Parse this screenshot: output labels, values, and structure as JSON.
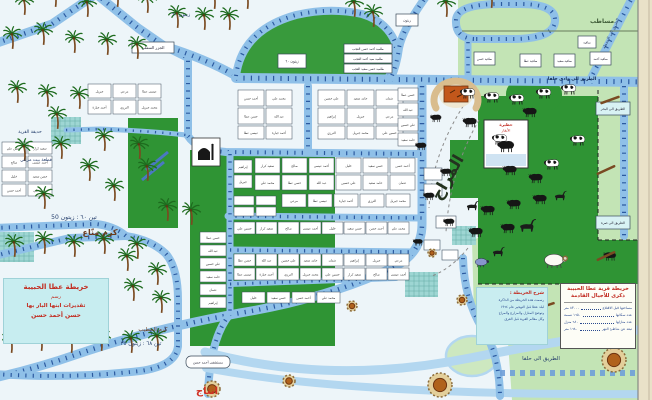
{
  "colors": {
    "bg": "#edf5f9",
    "road": "#8fc0e8",
    "road_light": "#b3d7f0",
    "tick": "#2c5aa0",
    "light_green": "#c3e4b5",
    "dark_green": "#2f9434",
    "dome": "#389a3c",
    "teal": "#9ed6d3",
    "edge": "#e9e1c8",
    "pond": "#cde8c0"
  },
  "legend": {
    "title1": "خريطة قرية عطا الحبيبة",
    "title2": "ذكرى للأجيال القادمة",
    "stats": [
      {
        "label": "مساحتها قبل الاقتلاع",
        "value": "٨٣٠٠٠ متر"
      },
      {
        "label": "عدد سكانها",
        "value": "١٦٥٠ نسمة"
      },
      {
        "label": "عدد منازلها",
        "value": "٦٨٠ منزل"
      },
      {
        "label": "تبعد عن شاطئ النهر",
        "value": "١٦٨٠ متر"
      }
    ]
  },
  "note_box": {
    "heading": "شرح الخريطة :",
    "lines": [
      "رسمت هذه الخريطة من الذاكرة",
      "لبلد عطا قبل التهجير عام ١٩٦٤",
      "وتوضح المنازل والمزارع والمراح",
      "وكل معالم القرية قبل الغرق"
    ]
  },
  "artist_box": {
    "lines": [
      "خريطة عطا الحبيبة",
      "رسم",
      "تقديرات ابنها البار بها",
      "حسن أحمد حسن"
    ]
  },
  "school": {
    "x": 484,
    "y": 120,
    "w": 44,
    "h": 48,
    "label1": "حظيرة",
    "label2": "الأبقار"
  },
  "mosque": {
    "x": 192,
    "y": 138,
    "w": 28,
    "h": 28
  },
  "horseshoe": {
    "cx": 456,
    "cy": 95
  },
  "areas": {
    "light_poly": "M458,0 L652,0 L652,400 L512,400 L508,342 L474,316 L472,240 L478,238 L478,88 L458,84 Z",
    "dome": "M236,76 Q242,30 296,15 Q330,7 362,14 Q386,21 395,42 Q399,62 388,78 Z",
    "rects": [
      {
        "x": 128,
        "y": 118,
        "w": 50,
        "h": 110,
        "f": "dark_green",
        "name": "dark-green-field"
      },
      {
        "x": 190,
        "y": 150,
        "w": 145,
        "h": 196,
        "f": "dark_green",
        "name": "dark-green-field"
      },
      {
        "x": 478,
        "y": 96,
        "w": 120,
        "h": 188,
        "f": "dark_green",
        "name": "cattle-pasture"
      },
      {
        "x": 506,
        "y": 80,
        "w": 56,
        "h": 30,
        "rx": 14,
        "f": "dark_green",
        "name": "cattle-pasture"
      },
      {
        "x": 598,
        "y": 240,
        "w": 40,
        "h": 44,
        "f": "dark_green",
        "name": "cattle-pasture"
      },
      {
        "x": 450,
        "y": 140,
        "w": 28,
        "h": 58,
        "f": "dark_green",
        "name": "dark-green-field"
      },
      {
        "x": 51,
        "y": 117,
        "w": 30,
        "h": 27,
        "f": "teal",
        "grid": 1,
        "name": "village-garden"
      },
      {
        "x": 0,
        "y": 232,
        "w": 34,
        "h": 30,
        "f": "teal",
        "grid": 1,
        "name": "village-garden"
      },
      {
        "x": 405,
        "y": 272,
        "w": 33,
        "h": 25,
        "f": "teal",
        "grid": 1,
        "name": "village-garden"
      },
      {
        "x": 452,
        "y": 226,
        "w": 24,
        "h": 19,
        "f": "teal",
        "grid": 1,
        "name": "village-garden"
      }
    ],
    "ponds": [
      {
        "cx": 472,
        "cy": 356,
        "rx": 26,
        "ry": 20
      },
      {
        "cx": 497,
        "cy": 331,
        "rx": 15,
        "ry": 12
      }
    ]
  },
  "roads": [
    {
      "d": "M96,-6 L52,24 L-6,44",
      "w": 9,
      "t": 1
    },
    {
      "d": "M96,-6 L138,28 L164,46",
      "w": 9,
      "t": 1
    },
    {
      "d": "M164,46 L188,58 L188,134",
      "w": 8,
      "t": 1
    },
    {
      "d": "M164,46 Q204,58 236,76",
      "w": 9,
      "t": 1
    },
    {
      "d": "M236,78 L652,82",
      "w": 10,
      "t": 1
    },
    {
      "d": "M236,76 Q242,30 296,15 Q330,7 362,14 Q386,21 395,42 Q399,62 388,78",
      "w": 8,
      "t": 1
    },
    {
      "d": "M428,-6 Q403,28 399,48 Q397,64 391,78",
      "w": 8,
      "t": 1
    },
    {
      "d": "M474,39 Q455,38 456,20 Q457,4 500,4 L520,4 Q556,4 555,21 Q554,38 516,39 L474,39",
      "w": 8,
      "t": 1
    },
    {
      "d": "M468,42 L468,78",
      "w": 7,
      "t": 1
    },
    {
      "d": "M634,-6 L590,80",
      "w": 8,
      "t": 1
    },
    {
      "d": "M624,86 L624,236",
      "w": 8,
      "t": 1
    },
    {
      "d": "M422,86 L422,224 Q422,252 396,266 Q330,298 240,313 Q148,330 78,354 Q38,368 -6,378",
      "w": 9,
      "t": 1
    },
    {
      "d": "M230,314 Q210,338 208,394",
      "w": 8,
      "t": 1
    },
    {
      "d": "M-6,256 L70,238 L126,236",
      "w": 8,
      "t": 1
    },
    {
      "d": "M126,236 Q152,240 166,254 Q178,268 178,300 L178,346",
      "w": 8,
      "t": 1
    },
    {
      "d": "M178,346 Q176,366 140,371 Q70,379 -6,374",
      "w": 8,
      "t": 1
    },
    {
      "d": "M-6,228 L96,224 Q114,226 126,236",
      "w": 8,
      "t": 1
    },
    {
      "d": "M188,136 Q197,150 226,152 L422,154",
      "w": 8,
      "t": 1
    },
    {
      "d": "M308,86 L308,152",
      "w": 8,
      "t": 1
    },
    {
      "d": "M228,216 L422,218",
      "w": 7,
      "t": 1
    },
    {
      "d": "M230,154 L230,312",
      "w": 7,
      "t": 1
    },
    {
      "d": "M230,250 L414,252",
      "w": 7,
      "t": 1
    },
    {
      "d": "M230,284 L396,278",
      "w": 6,
      "t": 1
    },
    {
      "d": "M66,130 L100,129 Q150,131 186,135",
      "w": 5,
      "t": 1
    },
    {
      "d": "M205,352 Q330,386 470,358 Q560,340 652,328",
      "w": 9,
      "t": 0,
      "c": "road_light"
    },
    {
      "d": "M206,368 Q350,396 652,394",
      "w": 8,
      "t": 0,
      "c": "road_light"
    },
    {
      "d": "M463,258 Q464,298 482,328 Q499,352 500,396",
      "w": 8,
      "t": 1
    },
    {
      "d": "M500,373 L652,373",
      "dashroad": 1
    }
  ],
  "dashes": [
    {
      "d": "M598,90 L598,240",
      "c": "#222222",
      "w": 1,
      "dash": "4 3"
    },
    {
      "d": "M478,284 L598,284",
      "c": "#222222",
      "w": 1,
      "dash": "4 3"
    },
    {
      "d": "M598,240 L638,240",
      "c": "#222222",
      "w": 1,
      "dash": "4 3"
    },
    {
      "d": "M470,96 Q432,150 429,208",
      "c": "#8a8a8a",
      "w": 1,
      "dash": "3 3"
    },
    {
      "d": "M479,120 Q450,170 446,232",
      "c": "#8a8a8a",
      "w": 1,
      "dash": "3 3"
    },
    {
      "d": "M468,248 Q452,268 432,276",
      "c": "#8a8a8a",
      "w": 1,
      "dash": "3 3"
    },
    {
      "d": "M462,31 L652,31",
      "c": "#7a8f6e",
      "w": 1.2,
      "dash": ""
    },
    {
      "d": "M146,170 L168,152",
      "c": "#4a78c2",
      "w": 3,
      "dash": ""
    },
    {
      "d": "M142,180 L164,162",
      "c": "#4a78c2",
      "w": 3,
      "dash": ""
    }
  ],
  "houses": {
    "names": [
      "أحمد حسن",
      "محمد علي",
      "حسن عطا",
      "عبد الله",
      "علي حسين",
      "حامد سعيد",
      "عثمان",
      "إبراهيم",
      "جبريل",
      "مرعي",
      "عيسى عطا",
      "أحمد جبارة",
      "الترزي",
      "محمد جبريل",
      "حسين علي",
      "سعيد كرار",
      "صالح",
      "أحمد عيسى",
      "خليل",
      "حسن سعيد"
    ],
    "clusters": [
      {
        "x": 238,
        "y": 90,
        "cols": 2,
        "rows": 2,
        "cw": 26,
        "ch": 16,
        "gx": 2,
        "gy": 2
      },
      {
        "x": 318,
        "y": 90,
        "cols": 3,
        "rows": 2,
        "cw": 27,
        "ch": 16,
        "gx": 2,
        "gy": 2
      },
      {
        "x": 238,
        "y": 126,
        "cols": 2,
        "rows": 1,
        "cw": 26,
        "ch": 13,
        "gx": 2,
        "gy": 0
      },
      {
        "x": 318,
        "y": 126,
        "cols": 3,
        "rows": 1,
        "cw": 27,
        "ch": 13,
        "gx": 2,
        "gy": 0
      },
      {
        "x": 255,
        "y": 158,
        "cols": 6,
        "rows": 2,
        "cw": 25,
        "ch": 15,
        "gx": 2,
        "gy": 2
      },
      {
        "x": 234,
        "y": 160,
        "cols": 1,
        "rows": 2,
        "cw": 18,
        "ch": 13,
        "gx": 0,
        "gy": 2
      },
      {
        "x": 282,
        "y": 194,
        "cols": 5,
        "rows": 1,
        "cw": 24,
        "ch": 13,
        "gx": 2,
        "gy": 0
      },
      {
        "x": 234,
        "y": 196,
        "cols": 2,
        "rows": 2,
        "cw": 20,
        "ch": 9,
        "gx": 2,
        "gy": 2
      },
      {
        "x": 234,
        "y": 222,
        "cols": 8,
        "rows": 1,
        "cw": 21,
        "ch": 12,
        "gx": 1,
        "gy": 0
      },
      {
        "x": 234,
        "y": 254,
        "cols": 8,
        "rows": 2,
        "cw": 21,
        "ch": 12,
        "gx": 1,
        "gy": 2
      },
      {
        "x": 242,
        "y": 292,
        "cols": 4,
        "rows": 1,
        "cw": 23,
        "ch": 11,
        "gx": 2,
        "gy": 0
      },
      {
        "x": 200,
        "y": 232,
        "cols": 1,
        "rows": 6,
        "cw": 26,
        "ch": 11,
        "gx": 0,
        "gy": 2
      },
      {
        "x": 88,
        "y": 84,
        "cols": 3,
        "rows": 2,
        "cw": 23,
        "ch": 14,
        "gx": 2,
        "gy": 2
      },
      {
        "x": 2,
        "y": 142,
        "cols": 2,
        "rows": 4,
        "cw": 24,
        "ch": 12,
        "gx": 2,
        "gy": 2
      },
      {
        "x": 398,
        "y": 88,
        "cols": 1,
        "rows": 4,
        "cw": 20,
        "ch": 13,
        "gx": 0,
        "gy": 2
      }
    ],
    "pens": [
      [
        424,
        168,
        18,
        12
      ],
      [
        424,
        184,
        18,
        12
      ],
      [
        436,
        216,
        20,
        12
      ],
      [
        424,
        240,
        16,
        10
      ],
      [
        442,
        250,
        16,
        10
      ]
    ],
    "named": [
      {
        "x": 344,
        "y": 44,
        "w": 48,
        "h": 9,
        "t": "طلمبة أحمد حسن العجب",
        "s": 3
      },
      {
        "x": 344,
        "y": 54,
        "w": 48,
        "h": 9,
        "t": "طلمبة سيد أحمد العجب",
        "s": 3
      },
      {
        "x": 344,
        "y": 64,
        "w": 48,
        "h": 9,
        "t": "طلمبة حسن سعيد العجب",
        "s": 3
      },
      {
        "x": 132,
        "y": 42,
        "w": 42,
        "h": 11,
        "t": "الجزر السفلي",
        "s": 4
      },
      {
        "x": 278,
        "y": 54,
        "w": 28,
        "h": 14,
        "t": "زيتون ٦٠",
        "s": 3.6
      },
      {
        "x": 396,
        "y": 14,
        "w": 22,
        "h": 12,
        "t": "زيتون",
        "s": 3.4
      },
      {
        "x": 474,
        "y": 52,
        "w": 21,
        "h": 13,
        "t": "ساقية حسن",
        "s": 3
      },
      {
        "x": 520,
        "y": 54,
        "w": 21,
        "h": 13,
        "t": "ساقية عطا",
        "s": 3
      },
      {
        "x": 554,
        "y": 54,
        "w": 21,
        "h": 13,
        "t": "ساقية سعيد",
        "s": 3
      },
      {
        "x": 590,
        "y": 52,
        "w": 21,
        "h": 13,
        "t": "ساقية أحمد",
        "s": 3
      },
      {
        "x": 578,
        "y": 36,
        "w": 18,
        "h": 12,
        "t": "ساقية",
        "s": 3
      },
      {
        "x": 596,
        "y": 102,
        "w": 34,
        "h": 13,
        "t": "الطريق الى البحر",
        "s": 3.4,
        "f": "#d8f2f4"
      },
      {
        "x": 596,
        "y": 216,
        "w": 34,
        "h": 13,
        "t": "الطريق الى صرة",
        "s": 3.4,
        "f": "#d8f2f4"
      },
      {
        "x": 186,
        "y": 356,
        "w": 44,
        "h": 12,
        "t": "مستشفى أحمد حسن",
        "s": 3.4,
        "rx": 5
      }
    ]
  },
  "wells": [
    [
      212,
      389,
      8
    ],
    [
      289,
      381,
      6
    ],
    [
      440,
      385,
      12
    ],
    [
      614,
      360,
      12
    ],
    [
      462,
      300,
      5
    ],
    [
      432,
      253,
      4
    ],
    [
      352,
      306,
      5
    ]
  ],
  "trees": [
    [
      25,
      14
    ],
    [
      56,
      6
    ],
    [
      88,
      16
    ],
    [
      118,
      6
    ],
    [
      148,
      12
    ],
    [
      178,
      27
    ],
    [
      205,
      29
    ],
    [
      230,
      29
    ],
    [
      248,
      8
    ],
    [
      215,
      8
    ],
    [
      13,
      48
    ],
    [
      44,
      44
    ],
    [
      75,
      52
    ],
    [
      108,
      54
    ],
    [
      138,
      58
    ],
    [
      355,
      16
    ],
    [
      374,
      26
    ],
    [
      447,
      16
    ],
    [
      492,
      7
    ],
    [
      18,
      102
    ],
    [
      48,
      106
    ],
    [
      80,
      108
    ],
    [
      58,
      128
    ],
    [
      105,
      150
    ],
    [
      140,
      158
    ],
    [
      25,
      160
    ],
    [
      62,
      158
    ],
    [
      90,
      180
    ],
    [
      148,
      180
    ],
    [
      115,
      200
    ],
    [
      45,
      208
    ],
    [
      168,
      220
    ],
    [
      192,
      224
    ],
    [
      15,
      256
    ],
    [
      45,
      253
    ],
    [
      75,
      256
    ],
    [
      105,
      253
    ],
    [
      138,
      258
    ],
    [
      128,
      270
    ],
    [
      158,
      284
    ],
    [
      134,
      300
    ],
    [
      162,
      312
    ],
    [
      12,
      352
    ],
    [
      42,
      350
    ],
    [
      72,
      352
    ],
    [
      102,
      350
    ],
    [
      132,
      352
    ],
    [
      158,
      350
    ]
  ],
  "animals": {
    "bw": [
      [
        468,
        93
      ],
      [
        492,
        97
      ],
      [
        517,
        99
      ],
      [
        544,
        93
      ],
      [
        569,
        89
      ],
      [
        578,
        140
      ],
      [
        552,
        164
      ],
      [
        500,
        139
      ]
    ],
    "dark": [
      [
        530,
        112
      ],
      [
        470,
        122
      ],
      [
        510,
        170
      ],
      [
        536,
        178
      ],
      [
        488,
        210
      ],
      [
        514,
        204
      ],
      [
        540,
        199
      ],
      [
        476,
        232
      ],
      [
        508,
        228
      ],
      [
        436,
        118,
        0.8
      ],
      [
        421,
        146,
        0.8
      ],
      [
        446,
        172,
        0.8
      ],
      [
        429,
        196,
        0.8
      ],
      [
        449,
        222,
        0.8
      ],
      [
        418,
        242,
        0.7
      ],
      [
        610,
        256,
        0.9
      ],
      [
        506,
        146,
        1.2
      ]
    ],
    "goat": [
      [
        472,
        206
      ],
      [
        527,
        226,
        1.35
      ],
      [
        498,
        252
      ],
      [
        560,
        196
      ]
    ],
    "sheep": [
      [
        482,
        262
      ]
    ],
    "ram": [
      [
        556,
        260
      ]
    ],
    "sticks": [
      [
        606,
        170,
        -25
      ],
      [
        606,
        256,
        -25
      ],
      [
        545,
        306,
        -18
      ],
      [
        610,
        100,
        -20
      ],
      [
        624,
        300,
        -20
      ]
    ]
  },
  "labels": [
    {
      "t": "المراح",
      "x": 452,
      "y": 180,
      "s": 16,
      "c": "#23321f",
      "w": "bold",
      "r": -60
    },
    {
      "t": "انتاج",
      "x": 207,
      "y": 394,
      "s": 10,
      "c": "#d03022",
      "w": "bold"
    },
    {
      "t": "كرم منّاع",
      "x": 100,
      "y": 235,
      "s": 8,
      "c": "#6b3a1e",
      "w": "bold"
    },
    {
      "t": "تين ٦٠ : زيتون 50",
      "x": 74,
      "y": 219,
      "s": 6,
      "c": "#27406e"
    },
    {
      "t": "كرم الخطيب",
      "x": 153,
      "y": 331,
      "s": 5.5,
      "c": "#6b3a1e"
    },
    {
      "t": "تين ٦٨ : زيتون ٣٥",
      "x": 141,
      "y": 345,
      "s": 5.5,
      "c": "#27406e"
    },
    {
      "t": "حديقة القرية",
      "x": 30,
      "y": 133,
      "s": 4.5,
      "c": "#27406e"
    },
    {
      "t": "قطعة بيت مرعي",
      "x": 36,
      "y": 161,
      "s": 4.5,
      "c": "#27406e"
    },
    {
      "t": "مساطب",
      "x": 602,
      "y": 23,
      "s": 6,
      "c": "#3f5c38",
      "w": "bold"
    },
    {
      "t": "زيتون ٦٠",
      "x": 181,
      "y": 16,
      "s": 5,
      "c": "#27406e"
    },
    {
      "t": "الطريق الى وادي حلفا",
      "x": 572,
      "y": 80,
      "s": 4.4,
      "c": "#102a55",
      "w": "bold"
    },
    {
      "t": "الطريق الى حلفا",
      "x": 541,
      "y": 360,
      "s": 5.5,
      "c": "#27406e"
    },
    {
      "t": "الطريق الى المحطة",
      "x": 612,
      "y": 34,
      "s": 4,
      "c": "#27406e",
      "r": -64
    }
  ]
}
